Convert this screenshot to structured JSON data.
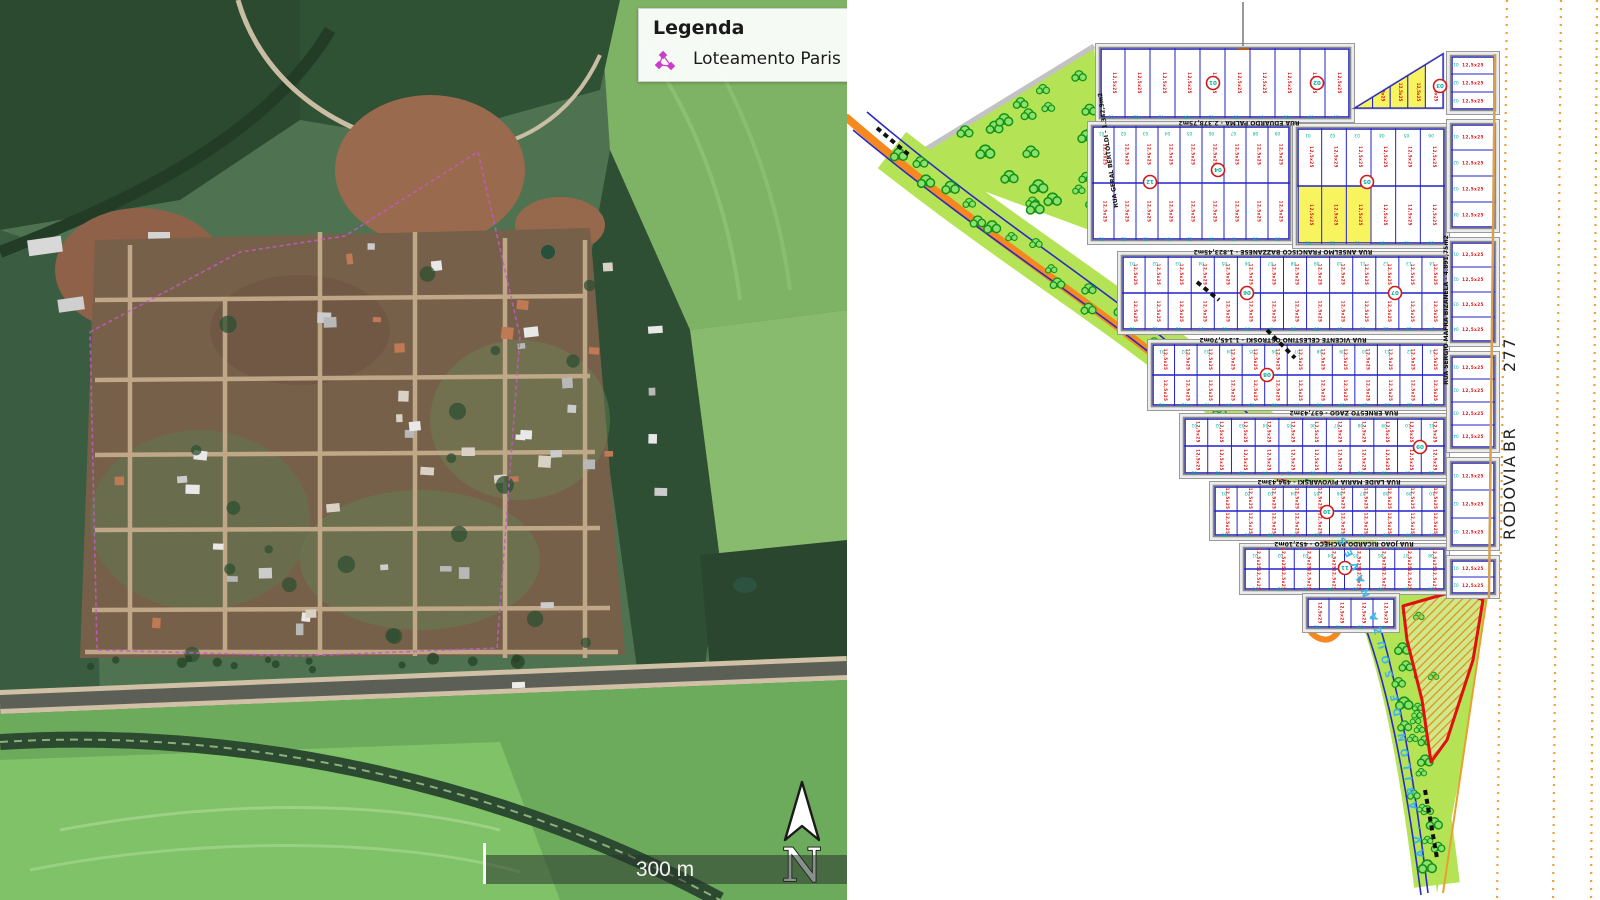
{
  "left_panel": {
    "legend": {
      "title": "Legenda",
      "items": [
        {
          "label": "Loteamento Paris",
          "marker_color": "#c93ec9"
        }
      ]
    },
    "scale_bar": {
      "label": "300 m"
    },
    "north_arrow": {
      "label": "N"
    }
  },
  "right_panel": {
    "highway": {
      "label": "RODOVIA BR 277",
      "label_parts": [
        "RODOVIA",
        "BR",
        "277"
      ]
    },
    "avenue": {
      "label": "AV. ABILON  DE  SOUZA NAVES",
      "label_color": "#3db7e8"
    },
    "streets": [
      {
        "name": "RUA EDUARDO PALMA",
        "area": "2.378,75m2"
      },
      {
        "name": "RUA ANSELMO FRANCISCO BAZZANESE",
        "area": "1.823,45m2"
      },
      {
        "name": "RUA VICENTE CELESTINO OSTROSKI",
        "area": "1.145,70m2"
      },
      {
        "name": "RUA ERNESTO ZAGO",
        "area": "637,43m2"
      },
      {
        "name": "RUA LAIDE MARIA PIVOVARSKI",
        "area": "494,43m2"
      },
      {
        "name": "RUA JOAO RICARDO PACHECO",
        "area": "452,10m2"
      },
      {
        "name": "RUA GERAL BERTOLDI",
        "area": "1.342,9m2"
      },
      {
        "name": "RUA SERGIO MAFRA BIZANELA",
        "area": "4.891,75m2"
      }
    ],
    "quadra_numbers": [
      "01",
      "02",
      "03",
      "04",
      "05",
      "06",
      "07",
      "08",
      "09",
      "10",
      "11",
      "12"
    ],
    "lot_dim_label": "12,5x25",
    "colors": {
      "lot_line": "#2222cc",
      "street_gray": "#9a9a9a",
      "green_area": "#b4e356",
      "tree_stroke": "#149414",
      "tree_fill": "#8ce06e",
      "road_orange": "#f5881f",
      "yellow_lot": "#f8f460",
      "hatch_red": "#e01010",
      "hatch_orange": "#e0921e",
      "dim_red": "#dd1111",
      "lot_number_teal": "#00b2a0",
      "highway_dotted": "#f0a030"
    }
  },
  "map_geometry": {
    "park": [
      [
        58,
        162
      ],
      [
        247,
        46
      ],
      [
        264,
        238
      ]
    ],
    "strip_path": "M 45,150 C 175,252 285,318 365,388 C 438,452 486,505 520,572 C 550,640 572,735 590,885",
    "orange_path": "M 0,118 C 135,235 250,305 335,378 C 412,446 455,497 492,566",
    "loop_path": "M 492,566 C 474,594 450,624 468,636 C 492,652 504,612 497,582",
    "blue_paths": [
      "M 20,112 C 150,222 262,290 345,362 C 423,430 470,483 505,552 C 538,620 560,720 581,893",
      "M 6,130 C 138,240 252,308 336,380 C 414,448 459,500 494,570 C 530,640 553,735 574,895"
    ],
    "label_path": "M 581,893 C 560,720 538,620 505,552 C 470,483 423,430 345,362",
    "wedge": [
      [
        520,
        592
      ],
      [
        640,
        596
      ],
      [
        612,
        780
      ],
      [
        590,
        893
      ],
      [
        575,
        770
      ],
      [
        543,
        650
      ]
    ],
    "wedge_edge": "M 640,596 L 596,893",
    "hatch_area": [
      [
        556,
        606
      ],
      [
        612,
        590
      ],
      [
        636,
        600
      ],
      [
        626,
        660
      ],
      [
        600,
        740
      ],
      [
        584,
        762
      ],
      [
        575,
        700
      ],
      [
        560,
        640
      ]
    ],
    "blocks": [
      {
        "x": 253,
        "y": 48,
        "w": 250,
        "h": 70,
        "rows": 1,
        "cols": 10
      },
      {
        "x": 245,
        "y": 126,
        "w": 198,
        "h": 114,
        "rows": 2,
        "cols": 9
      },
      {
        "x": 450,
        "y": 128,
        "w": 148,
        "h": 116,
        "rows": 2,
        "cols": 6,
        "yellow": [
          [
            1,
            0
          ],
          [
            1,
            1
          ],
          [
            1,
            2
          ]
        ]
      },
      {
        "x": 275,
        "y": 256,
        "w": 323,
        "h": 74,
        "rows": 2,
        "cols": 14
      },
      {
        "x": 305,
        "y": 344,
        "w": 293,
        "h": 62,
        "rows": 2,
        "cols": 13
      },
      {
        "x": 337,
        "y": 418,
        "w": 261,
        "h": 56,
        "rows": 2,
        "cols": 11
      },
      {
        "x": 367,
        "y": 486,
        "w": 231,
        "h": 50,
        "rows": 2,
        "cols": 10
      },
      {
        "x": 397,
        "y": 548,
        "w": 201,
        "h": 42,
        "rows": 2,
        "cols": 8
      },
      {
        "x": 460,
        "y": 598,
        "w": 88,
        "h": 30,
        "rows": 1,
        "cols": 4
      }
    ],
    "right_col": {
      "x": 604,
      "w": 44,
      "segments": [
        {
          "y": 56,
          "h": 54,
          "cols": 3
        },
        {
          "y": 124,
          "h": 104,
          "cols": 4
        },
        {
          "y": 242,
          "h": 100,
          "cols": 4
        },
        {
          "y": 356,
          "h": 92,
          "cols": 4
        },
        {
          "y": 462,
          "h": 84,
          "cols": 3
        },
        {
          "y": 560,
          "h": 34,
          "cols": 2
        }
      ]
    },
    "yellow_triangle": [
      [
        508,
        108
      ],
      [
        596,
        54
      ],
      [
        596,
        108
      ]
    ],
    "street_label_pos": [
      [
        392,
        121,
        180
      ],
      [
        436,
        250,
        180
      ],
      [
        436,
        338,
        180
      ],
      [
        497,
        411,
        180
      ],
      [
        482,
        480,
        180
      ],
      [
        497,
        542,
        180
      ],
      [
        263,
        150,
        262
      ],
      [
        601,
        310,
        -90
      ]
    ],
    "quadras": [
      [
        366,
        83
      ],
      [
        470,
        83
      ],
      [
        593,
        86
      ],
      [
        371,
        170
      ],
      [
        520,
        182
      ],
      [
        400,
        293
      ],
      [
        548,
        293
      ],
      [
        420,
        375
      ],
      [
        573,
        447
      ],
      [
        480,
        512
      ],
      [
        498,
        568
      ],
      [
        303,
        182
      ]
    ],
    "highway": {
      "solid": [
        648,
        54,
        642,
        598
      ],
      "dotted": [
        [
          660,
          0,
          650,
          900
        ],
        [
          714,
          0,
          706,
          900
        ],
        [
          750,
          0,
          744,
          900
        ]
      ],
      "text_pos": [
        [
          668,
          540
        ],
        [
          668,
          452
        ],
        [
          668,
          372
        ]
      ]
    },
    "dashes": [
      "M 30,128 L 62,155",
      "M 350,282 L 372,300",
      "M 420,330 L 448,358",
      "M 578,790 L 590,858"
    ],
    "sat_house_regions": [
      {
        "x": 300,
        "y": 240,
        "w": 310,
        "h": 400,
        "n": 24
      },
      {
        "x": 480,
        "y": 290,
        "w": 180,
        "h": 200,
        "n": 16
      },
      {
        "x": 100,
        "y": 430,
        "w": 200,
        "h": 210,
        "n": 9
      }
    ]
  }
}
